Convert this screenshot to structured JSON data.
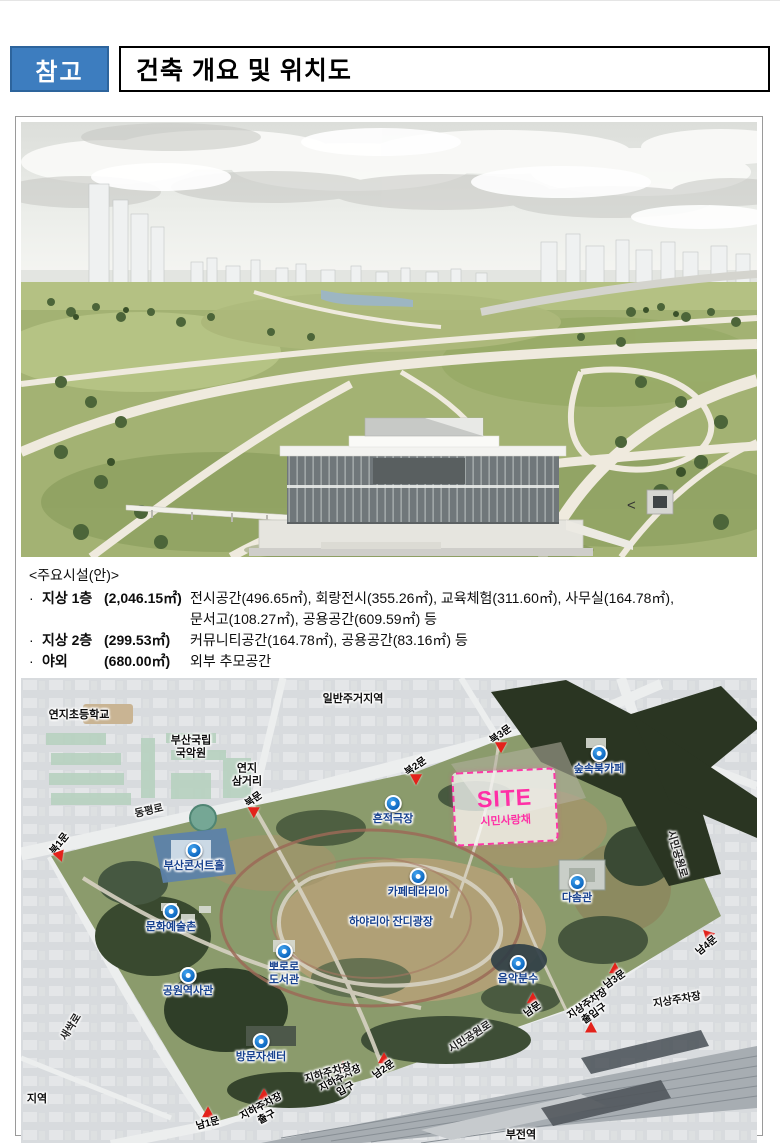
{
  "header": {
    "badge_label": "참고",
    "title": "건축 개요 및 위치도"
  },
  "colors": {
    "badge_blue": "#3d7dbf",
    "marker_blue": "#0d67c0",
    "poi_text": "#17418e",
    "site_pink": "#ff2fa6",
    "gate_red": "#e3221b"
  },
  "rendering": {
    "marker_glyph": "<"
  },
  "facilities": {
    "heading": "<주요시설(안)>",
    "rows": [
      {
        "bullet": "·",
        "name": "지상 1층",
        "area": "(2,046.15㎡)",
        "desc": "전시공간(496.65㎡), 회랑전시(355.26㎡), 교육체험(311.60㎡), 사무실(164.78㎡),\n문서고(108.27㎡), 공용공간(609.59㎡) 등"
      },
      {
        "bullet": "·",
        "name": "지상 2층",
        "area": "(299.53㎡)",
        "desc": "커뮤니티공간(164.78㎡), 공용공간(83.16㎡) 등"
      },
      {
        "bullet": "·",
        "name": "야외",
        "area": "(680.00㎡)",
        "desc": "외부 추모공간"
      }
    ]
  },
  "map": {
    "site": {
      "title": "SITE",
      "subtitle": "시민사랑채",
      "x": 432,
      "y": 92,
      "w": 100,
      "h": 70
    },
    "pois": [
      {
        "label": "숲속북카페",
        "x": 578,
        "y": 75
      },
      {
        "label": "흔적극장",
        "x": 372,
        "y": 125
      },
      {
        "label": "부산콘서트홀",
        "x": 173,
        "y": 172
      },
      {
        "label": "카페테라리아",
        "x": 397,
        "y": 198
      },
      {
        "label": "다솜관",
        "x": 556,
        "y": 204
      },
      {
        "label": "문화예술촌",
        "x": 150,
        "y": 233
      },
      {
        "label": "하야리아 잔디광장",
        "x": 370,
        "y": 246,
        "marker": false
      },
      {
        "label": "뽀로로\n도서관",
        "x": 263,
        "y": 273
      },
      {
        "label": "음악분수",
        "x": 497,
        "y": 285
      },
      {
        "label": "공원역사관",
        "x": 167,
        "y": 297
      },
      {
        "label": "방문자센터",
        "x": 240,
        "y": 363
      }
    ],
    "gates": [
      {
        "label": "북1문",
        "x": 39,
        "y": 172,
        "rot": -52,
        "arot": 160,
        "labelpos": "above"
      },
      {
        "label": "북문",
        "x": 233,
        "y": 128,
        "rot": -35,
        "arot": 180,
        "labelpos": "above"
      },
      {
        "label": "북2문",
        "x": 395,
        "y": 95,
        "rot": -35,
        "arot": 180,
        "labelpos": "above"
      },
      {
        "label": "북3문",
        "x": 480,
        "y": 63,
        "rot": -35,
        "arot": 180,
        "labelpos": "above"
      },
      {
        "label": "남1문",
        "x": 187,
        "y": 440,
        "rot": -15,
        "arot": 0,
        "labelpos": "below"
      },
      {
        "label": "지하주차장\n출구",
        "x": 243,
        "y": 428,
        "rot": -28,
        "arot": 0,
        "labelpos": "below"
      },
      {
        "label": "지하주차장\n입구",
        "x": 322,
        "y": 400,
        "rot": -28,
        "arot": 0,
        "labelpos": "below"
      },
      {
        "label": "남2문",
        "x": 363,
        "y": 386,
        "rot": -35,
        "arot": 0,
        "labelpos": "below"
      },
      {
        "label": "남문",
        "x": 512,
        "y": 326,
        "rot": -35,
        "arot": 0,
        "labelpos": "below"
      },
      {
        "label": "지상주차장\n출입구",
        "x": 570,
        "y": 337,
        "rot": -35,
        "arot": 0,
        "labelpos": "above"
      },
      {
        "label": "남3문",
        "x": 594,
        "y": 296,
        "rot": -35,
        "arot": 0,
        "labelpos": "below"
      },
      {
        "label": "남4문",
        "x": 686,
        "y": 262,
        "rot": -40,
        "arot": -45,
        "labelpos": "below"
      }
    ],
    "parking_labels": [
      {
        "label": "지하주차장",
        "x": 307,
        "y": 394,
        "rot": -16
      },
      {
        "label": "지상주차장",
        "x": 656,
        "y": 321,
        "rot": -10
      }
    ],
    "road_labels": [
      {
        "label": "동평로",
        "x": 128,
        "y": 132,
        "rot": -13
      },
      {
        "label": "새싹로",
        "x": 50,
        "y": 348,
        "rot": -58
      },
      {
        "label": "시민공원로",
        "x": 449,
        "y": 358,
        "rot": -33
      },
      {
        "label": "시민공원로",
        "x": 656,
        "y": 175,
        "rot": 74
      }
    ],
    "area_labels": [
      {
        "label": "연지초등학교",
        "x": 58,
        "y": 36
      },
      {
        "label": "일반주거지역",
        "x": 332,
        "y": 20
      },
      {
        "label": "부산국립\n국악원",
        "x": 170,
        "y": 70
      },
      {
        "label": "연지\n삼거리",
        "x": 226,
        "y": 98
      },
      {
        "label": "부전역",
        "x": 500,
        "y": 456
      },
      {
        "label": "지역",
        "x": 16,
        "y": 420
      }
    ]
  }
}
